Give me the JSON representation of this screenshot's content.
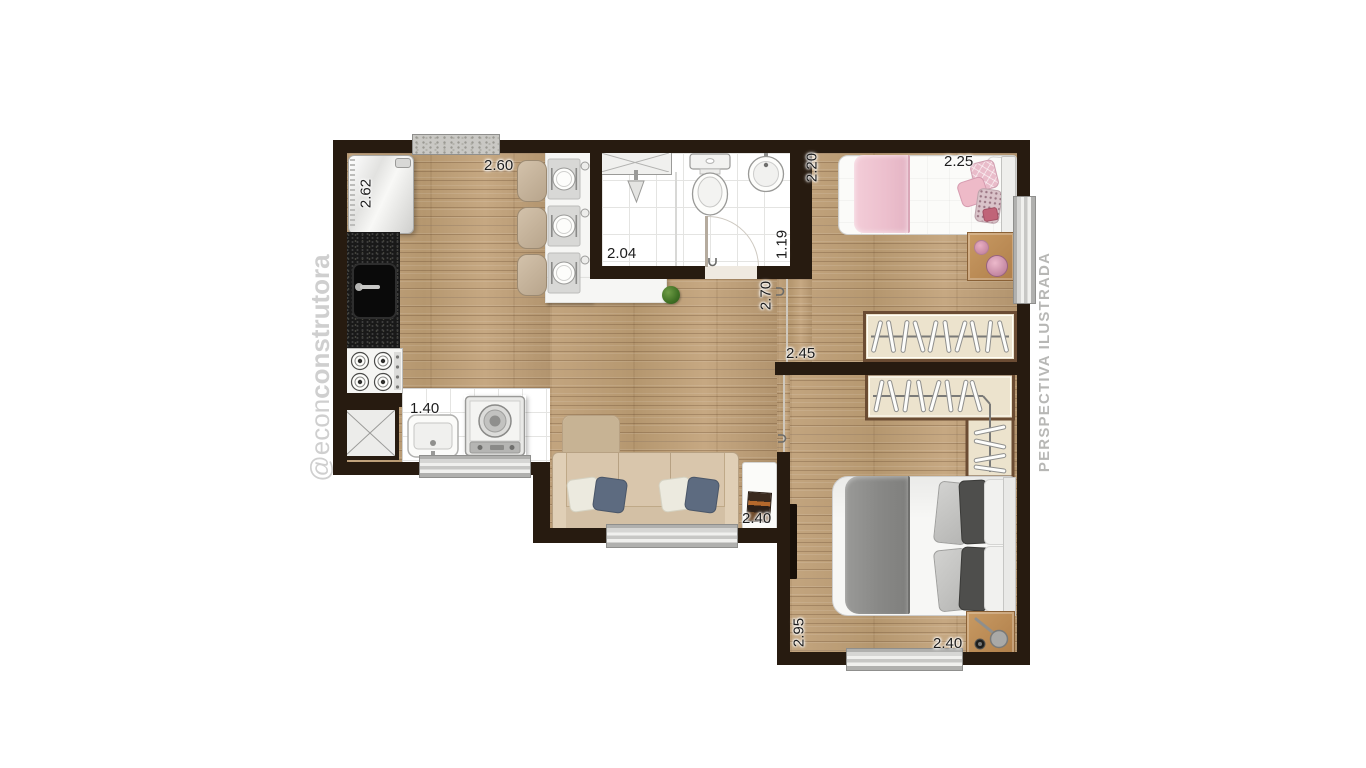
{
  "watermark": {
    "text_light": "@econ",
    "text_bold": "construtora"
  },
  "side_note": "PERSPECTIVA ILUSTRADA",
  "dimensions": {
    "kitchen_depth": "2.62",
    "kitchen_width": "2.60",
    "bath_shower_width": "2.04",
    "bath_width": "1.19",
    "bedroom2_depth": "2.20",
    "bedroom2_width": "2.25",
    "hall_depth": "2.70",
    "hall_width": "2.45",
    "service_width": "1.40",
    "living_width": "2.40",
    "bedroom1_depth": "2.95",
    "bedroom1_width": "2.40"
  },
  "colors": {
    "wall": "#271b10",
    "wood_floor": "#bda083",
    "tile_floor": "#ffffff",
    "counter": "#f6f6f4",
    "granite_counter": "#191919",
    "pink_bed": "#efc3cf",
    "gray_bed": "#8a8a88",
    "sofa": "#d9c6ac",
    "pillow_blue": "#5d6b80",
    "wardrobe_fill": "#ece3cd",
    "wardrobe_border": "#6b4c33",
    "window_frame": "#b0b0ae",
    "label_text": "#1c1c1c",
    "watermark_gray": "#cfcfcf",
    "side_note_gray": "#b7b7b5"
  }
}
